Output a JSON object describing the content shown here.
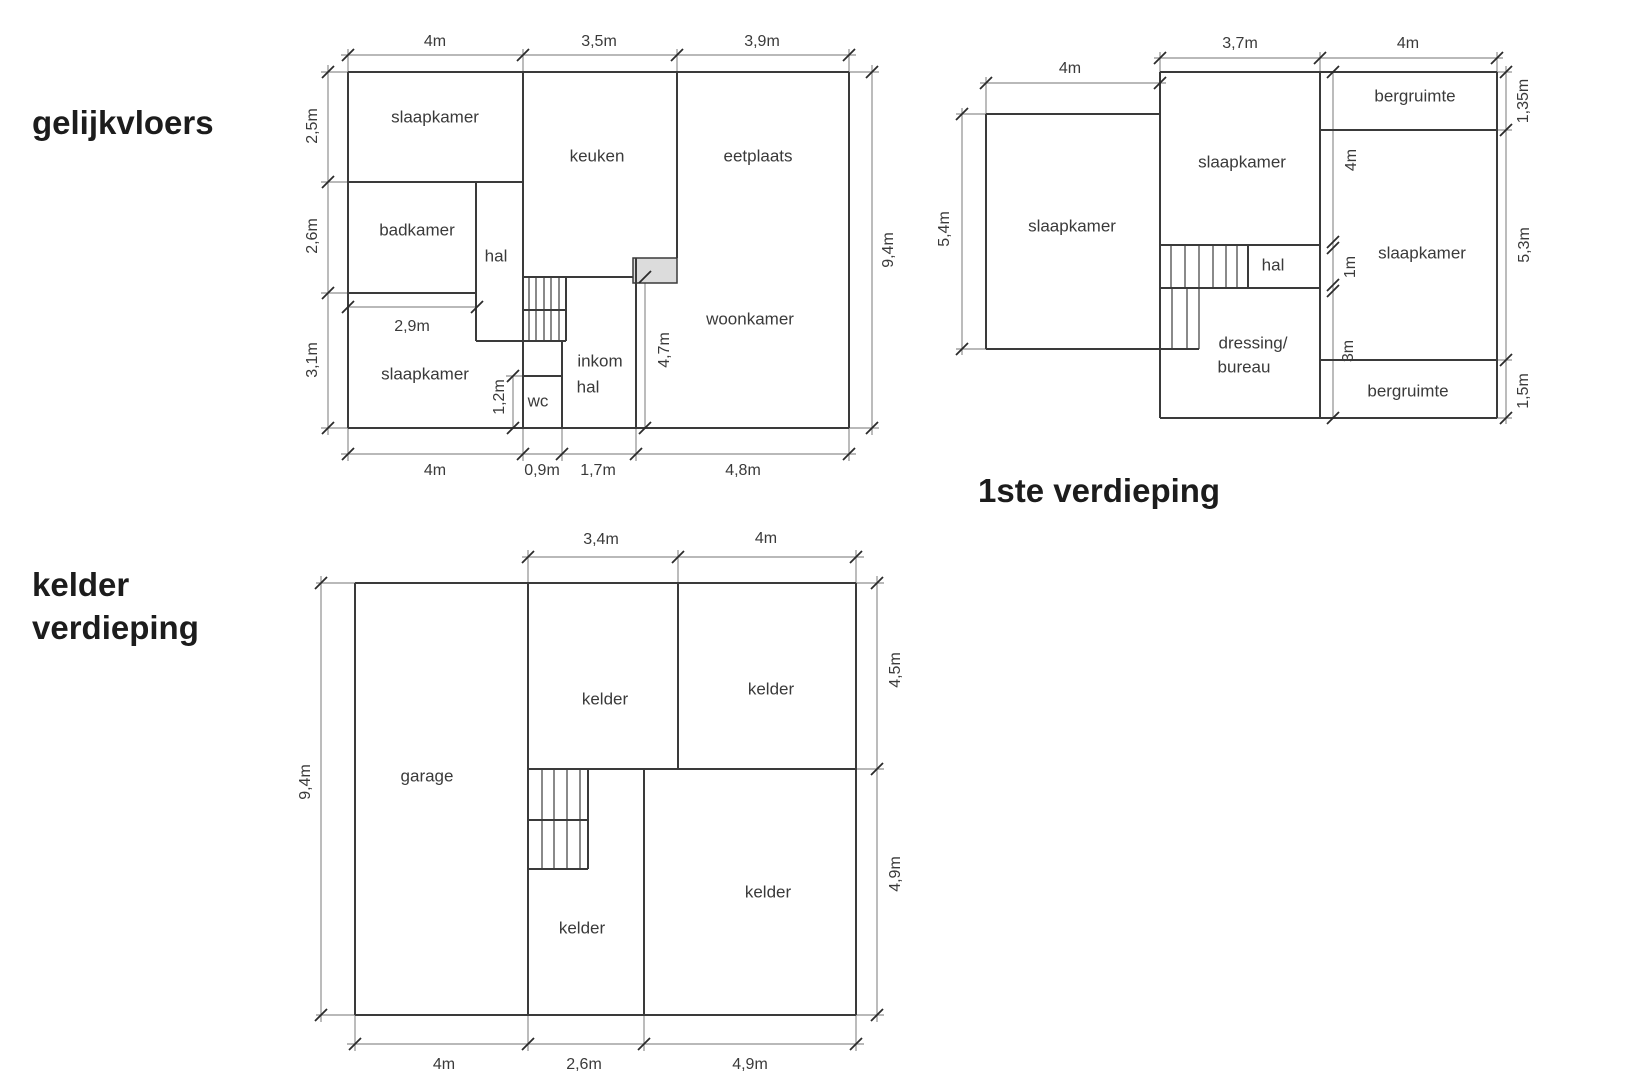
{
  "titles": {
    "ground": "gelijkvloers",
    "first": "1ste verdieping",
    "basement": [
      "kelder",
      "verdieping"
    ]
  },
  "colors": {
    "wall": "#3a3a3a",
    "stair": "#4a4a4a",
    "dim": "#8f8f8f",
    "tick": "#2b2b2b",
    "text": "#3a3a3a",
    "title": "#1c1c1c",
    "door_fill": "#dcdcdc"
  },
  "plans": [
    {
      "id": "gelijkvloers",
      "walls": [
        [
          348,
          72,
          849,
          72
        ],
        [
          348,
          428,
          849,
          428
        ],
        [
          348,
          72,
          348,
          428
        ],
        [
          849,
          72,
          849,
          428
        ],
        [
          523,
          72,
          523,
          428
        ],
        [
          476,
          182,
          476,
          341
        ],
        [
          566,
          277,
          566,
          341
        ],
        [
          562,
          341,
          562,
          428
        ],
        [
          636,
          258,
          636,
          428
        ],
        [
          677,
          72,
          677,
          258
        ],
        [
          348,
          182,
          523,
          182
        ],
        [
          348,
          293,
          476,
          293
        ],
        [
          523,
          277,
          633,
          277
        ],
        [
          476,
          341,
          566,
          341
        ],
        [
          523,
          310,
          566,
          310
        ],
        [
          523,
          376,
          562,
          376
        ]
      ],
      "stairs": [
        [
          529,
          277,
          529,
          341
        ],
        [
          536,
          277,
          536,
          341
        ],
        [
          544,
          277,
          544,
          341
        ],
        [
          551,
          277,
          551,
          341
        ],
        [
          559,
          277,
          559,
          341
        ]
      ],
      "boxes": [
        [
          633,
          258,
          44,
          25
        ]
      ],
      "dim_lines": [
        [
          341,
          55,
          856,
          55
        ],
        [
          341,
          454,
          856,
          454
        ],
        [
          328,
          65,
          328,
          435
        ],
        [
          872,
          65,
          872,
          435
        ],
        [
          348,
          307,
          477,
          307
        ],
        [
          513,
          376,
          513,
          428
        ],
        [
          645,
          277,
          645,
          428
        ]
      ],
      "ext_lines": [
        [
          348,
          72,
          348,
          49
        ],
        [
          523,
          72,
          523,
          49
        ],
        [
          677,
          72,
          677,
          49
        ],
        [
          849,
          72,
          849,
          49
        ],
        [
          348,
          428,
          348,
          461
        ],
        [
          523,
          428,
          523,
          461
        ],
        [
          562,
          428,
          562,
          461
        ],
        [
          636,
          428,
          636,
          461
        ],
        [
          849,
          428,
          849,
          461
        ],
        [
          348,
          72,
          321,
          72
        ],
        [
          348,
          182,
          321,
          182
        ],
        [
          348,
          293,
          321,
          293
        ],
        [
          348,
          428,
          321,
          428
        ],
        [
          849,
          72,
          879,
          72
        ],
        [
          849,
          428,
          879,
          428
        ],
        [
          523,
          376,
          506,
          376
        ]
      ],
      "ticks": [
        [
          348,
          55
        ],
        [
          523,
          55
        ],
        [
          677,
          55
        ],
        [
          849,
          55
        ],
        [
          348,
          454
        ],
        [
          523,
          454
        ],
        [
          562,
          454
        ],
        [
          636,
          454
        ],
        [
          849,
          454
        ],
        [
          328,
          72
        ],
        [
          328,
          182
        ],
        [
          328,
          293
        ],
        [
          328,
          428
        ],
        [
          872,
          72
        ],
        [
          872,
          428
        ],
        [
          348,
          307
        ],
        [
          477,
          307
        ],
        [
          513,
          376
        ],
        [
          513,
          428
        ],
        [
          645,
          277
        ],
        [
          645,
          428
        ]
      ],
      "dticks": [],
      "dim_labels": [
        {
          "t": "4m",
          "x": 435,
          "y": 42
        },
        {
          "t": "3,5m",
          "x": 599,
          "y": 42
        },
        {
          "t": "3,9m",
          "x": 762,
          "y": 42
        },
        {
          "t": "4m",
          "x": 435,
          "y": 471
        },
        {
          "t": "0,9m",
          "x": 542,
          "y": 471
        },
        {
          "t": "1,7m",
          "x": 598,
          "y": 471
        },
        {
          "t": "4,8m",
          "x": 743,
          "y": 471
        },
        {
          "t": "2,5m",
          "x": 313,
          "y": 126,
          "r": 1
        },
        {
          "t": "2,6m",
          "x": 313,
          "y": 236,
          "r": 1
        },
        {
          "t": "3,1m",
          "x": 313,
          "y": 360,
          "r": 1
        },
        {
          "t": "9,4m",
          "x": 889,
          "y": 250,
          "r": 1
        },
        {
          "t": "2,9m",
          "x": 412,
          "y": 327
        },
        {
          "t": "1,2m",
          "x": 500,
          "y": 397,
          "r": 1
        },
        {
          "t": "4,7m",
          "x": 665,
          "y": 350,
          "r": 1
        }
      ],
      "room_labels": [
        {
          "t": "slaapkamer",
          "x": 435,
          "y": 118
        },
        {
          "t": "keuken",
          "x": 597,
          "y": 157
        },
        {
          "t": "eetplaats",
          "x": 758,
          "y": 157
        },
        {
          "t": "badkamer",
          "x": 417,
          "y": 231
        },
        {
          "t": "hal",
          "x": 496,
          "y": 257
        },
        {
          "t": "woonkamer",
          "x": 750,
          "y": 320
        },
        {
          "t": "slaapkamer",
          "x": 425,
          "y": 375
        },
        {
          "t": "wc",
          "x": 538,
          "y": 402
        },
        {
          "t": "inkom",
          "x": 600,
          "y": 362
        },
        {
          "t": "hal",
          "x": 588,
          "y": 388
        }
      ]
    },
    {
      "id": "eerste-verdieping",
      "walls": [
        [
          986,
          114,
          1160,
          114
        ],
        [
          986,
          114,
          986,
          349
        ],
        [
          986,
          349,
          1199,
          349
        ],
        [
          1160,
          72,
          1160,
          418
        ],
        [
          1160,
          72,
          1497,
          72
        ],
        [
          1160,
          418,
          1497,
          418
        ],
        [
          1497,
          72,
          1497,
          418
        ],
        [
          1320,
          72,
          1320,
          418
        ],
        [
          1320,
          130,
          1497,
          130
        ],
        [
          1320,
          360,
          1497,
          360
        ],
        [
          1160,
          245,
          1320,
          245
        ],
        [
          1160,
          288,
          1320,
          288
        ],
        [
          1248,
          245,
          1248,
          288
        ]
      ],
      "stairs": [
        [
          1171,
          245,
          1171,
          288
        ],
        [
          1185,
          245,
          1185,
          288
        ],
        [
          1199,
          245,
          1199,
          288
        ],
        [
          1213,
          245,
          1213,
          288
        ],
        [
          1226,
          245,
          1226,
          288
        ],
        [
          1237,
          245,
          1237,
          288
        ],
        [
          1172,
          288,
          1172,
          349
        ],
        [
          1187,
          288,
          1187,
          349
        ],
        [
          1199,
          288,
          1199,
          349
        ]
      ],
      "boxes": [],
      "dim_lines": [
        [
          980,
          83,
          1166,
          83
        ],
        [
          1154,
          58,
          1503,
          58
        ],
        [
          962,
          108,
          962,
          355
        ],
        [
          1506,
          66,
          1506,
          424
        ],
        [
          1333,
          72,
          1333,
          418
        ]
      ],
      "ext_lines": [
        [
          986,
          114,
          986,
          77
        ],
        [
          1160,
          72,
          1160,
          52
        ],
        [
          1320,
          72,
          1320,
          52
        ],
        [
          1497,
          72,
          1497,
          52
        ],
        [
          986,
          114,
          956,
          114
        ],
        [
          986,
          349,
          956,
          349
        ],
        [
          1497,
          72,
          1512,
          72
        ],
        [
          1497,
          130,
          1512,
          130
        ],
        [
          1497,
          360,
          1512,
          360
        ],
        [
          1497,
          418,
          1512,
          418
        ]
      ],
      "ticks": [
        [
          986,
          83
        ],
        [
          1160,
          83
        ],
        [
          1160,
          58
        ],
        [
          1320,
          58
        ],
        [
          1497,
          58
        ],
        [
          962,
          114
        ],
        [
          962,
          349
        ],
        [
          1506,
          72
        ],
        [
          1506,
          130
        ],
        [
          1506,
          360
        ],
        [
          1506,
          418
        ],
        [
          1333,
          72
        ],
        [
          1333,
          418
        ]
      ],
      "dticks": [
        [
          1333,
          245
        ],
        [
          1333,
          288
        ]
      ],
      "dim_labels": [
        {
          "t": "4m",
          "x": 1070,
          "y": 69
        },
        {
          "t": "3,7m",
          "x": 1240,
          "y": 44
        },
        {
          "t": "4m",
          "x": 1408,
          "y": 44
        },
        {
          "t": "5,4m",
          "x": 945,
          "y": 229,
          "r": 1
        },
        {
          "t": "1,35m",
          "x": 1524,
          "y": 101,
          "r": 1
        },
        {
          "t": "5,3m",
          "x": 1525,
          "y": 245,
          "r": 1
        },
        {
          "t": "1,5m",
          "x": 1524,
          "y": 391,
          "r": 1
        },
        {
          "t": "4m",
          "x": 1352,
          "y": 160,
          "r": 1
        },
        {
          "t": "1m",
          "x": 1351,
          "y": 267,
          "r": 1
        },
        {
          "t": "3m",
          "x": 1349,
          "y": 351,
          "r": 1
        }
      ],
      "room_labels": [
        {
          "t": "slaapkamer",
          "x": 1072,
          "y": 227
        },
        {
          "t": "slaapkamer",
          "x": 1242,
          "y": 163
        },
        {
          "t": "bergruimte",
          "x": 1415,
          "y": 97
        },
        {
          "t": "hal",
          "x": 1273,
          "y": 266
        },
        {
          "t": "slaapkamer",
          "x": 1422,
          "y": 254
        },
        {
          "t": "dressing/",
          "x": 1253,
          "y": 344
        },
        {
          "t": "bureau",
          "x": 1244,
          "y": 368
        },
        {
          "t": "bergruimte",
          "x": 1408,
          "y": 392
        }
      ]
    },
    {
      "id": "kelder-verdieping",
      "walls": [
        [
          355,
          583,
          856,
          583
        ],
        [
          355,
          1015,
          856,
          1015
        ],
        [
          355,
          583,
          355,
          1015
        ],
        [
          856,
          583,
          856,
          1015
        ],
        [
          528,
          583,
          528,
          1015
        ],
        [
          678,
          583,
          678,
          769
        ],
        [
          528,
          769,
          856,
          769
        ],
        [
          644,
          769,
          644,
          1015
        ],
        [
          528,
          869,
          588,
          869
        ],
        [
          588,
          769,
          588,
          869
        ],
        [
          528,
          820,
          588,
          820
        ]
      ],
      "stairs": [
        [
          542,
          769,
          542,
          869
        ],
        [
          554,
          769,
          554,
          869
        ],
        [
          567,
          769,
          567,
          869
        ],
        [
          580,
          769,
          580,
          869
        ]
      ],
      "boxes": [],
      "dim_lines": [
        [
          522,
          557,
          864,
          557
        ],
        [
          321,
          576,
          321,
          1022
        ],
        [
          877,
          576,
          877,
          1022
        ],
        [
          347,
          1044,
          864,
          1044
        ]
      ],
      "ext_lines": [
        [
          528,
          583,
          528,
          550
        ],
        [
          678,
          583,
          678,
          550
        ],
        [
          856,
          583,
          856,
          550
        ],
        [
          355,
          583,
          316,
          583
        ],
        [
          355,
          1015,
          316,
          1015
        ],
        [
          856,
          583,
          884,
          583
        ],
        [
          856,
          769,
          884,
          769
        ],
        [
          856,
          1015,
          884,
          1015
        ],
        [
          355,
          1015,
          355,
          1051
        ],
        [
          528,
          1015,
          528,
          1051
        ],
        [
          644,
          1015,
          644,
          1051
        ],
        [
          856,
          1015,
          856,
          1051
        ]
      ],
      "ticks": [
        [
          528,
          557
        ],
        [
          678,
          557
        ],
        [
          856,
          557
        ],
        [
          321,
          583
        ],
        [
          321,
          1015
        ],
        [
          877,
          583
        ],
        [
          877,
          769
        ],
        [
          877,
          1015
        ],
        [
          355,
          1044
        ],
        [
          528,
          1044
        ],
        [
          644,
          1044
        ],
        [
          856,
          1044
        ]
      ],
      "dticks": [],
      "dim_labels": [
        {
          "t": "3,4m",
          "x": 601,
          "y": 540
        },
        {
          "t": "4m",
          "x": 766,
          "y": 539
        },
        {
          "t": "9,4m",
          "x": 306,
          "y": 782,
          "r": 1
        },
        {
          "t": "4,5m",
          "x": 896,
          "y": 670,
          "r": 1
        },
        {
          "t": "4,9m",
          "x": 896,
          "y": 874,
          "r": 1
        },
        {
          "t": "4m",
          "x": 444,
          "y": 1065
        },
        {
          "t": "2,6m",
          "x": 584,
          "y": 1065
        },
        {
          "t": "4,9m",
          "x": 750,
          "y": 1065
        }
      ],
      "room_labels": [
        {
          "t": "garage",
          "x": 427,
          "y": 777
        },
        {
          "t": "kelder",
          "x": 605,
          "y": 700
        },
        {
          "t": "kelder",
          "x": 771,
          "y": 690
        },
        {
          "t": "kelder",
          "x": 582,
          "y": 929
        },
        {
          "t": "kelder",
          "x": 768,
          "y": 893
        }
      ]
    }
  ]
}
